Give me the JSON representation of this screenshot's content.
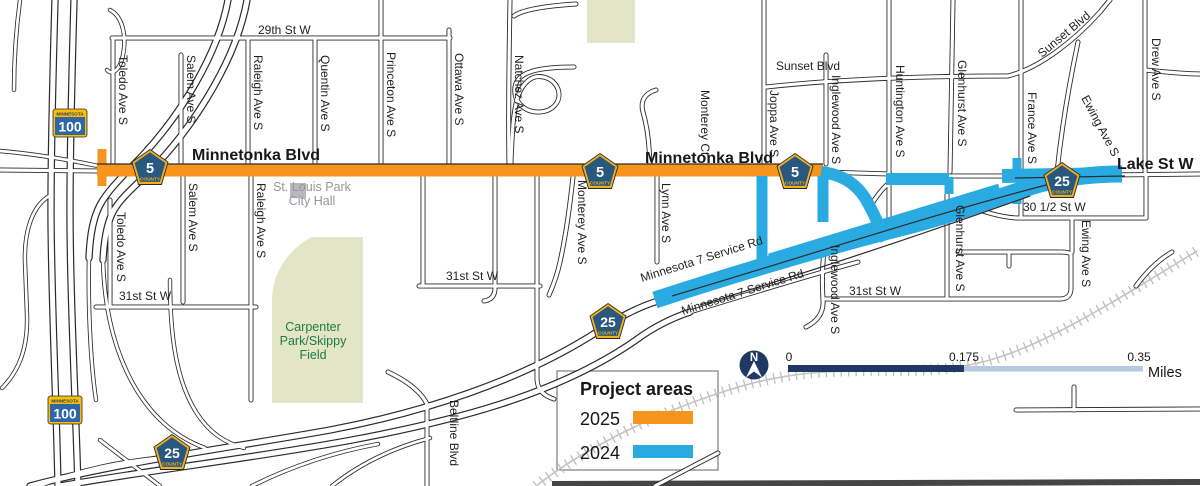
{
  "colors": {
    "orange_2025": "#F7941D",
    "blue_2024": "#29ABE2",
    "park_green": "#E3E5C7",
    "park_text_green": "#1E7A46",
    "gray_text": "#97969A",
    "navy": "#1F3864",
    "scale_light": "#B7C9E2",
    "shield_blue": "#29587E",
    "shield_gold": "#F2B01E",
    "state_blue": "#2E66A7",
    "state_gold": "#FABD08",
    "rail_gray": "#C4C4C4"
  },
  "legend": {
    "title": "Project areas",
    "items": [
      {
        "label": "2025",
        "color": "#F7941D"
      },
      {
        "label": "2024",
        "color": "#29ABE2"
      }
    ]
  },
  "scale_bar": {
    "zero": "0",
    "mid": "0.175",
    "max": "0.35",
    "unit": "Miles"
  },
  "north_arrow": {
    "letter": "N"
  },
  "shields": {
    "state": {
      "caption": "MINNESOTA",
      "number": "100"
    },
    "county_5": {
      "number": "5",
      "caption": "COUNTY"
    },
    "county_25": {
      "number": "25",
      "caption": "COUNTY"
    }
  },
  "major_roads": {
    "minnetonka_west": "Minnetonka Blvd",
    "minnetonka_east": "Minnetonka Blvd",
    "lake_st": "Lake St W"
  },
  "places": {
    "city_hall": {
      "line1": "St. Louis Park",
      "line2": "City Hall"
    },
    "carpenter_park": {
      "line1": "Carpenter",
      "line2": "Park/Skippy",
      "line3": "Field"
    }
  },
  "streets": {
    "s29th": "29th St W",
    "toledo": "Toledo Ave S",
    "salem": "Salem Ave S",
    "raleigh": "Raleigh Ave S",
    "quentin": "Quentin Ave S",
    "princeton": "Princeton Ave S",
    "ottawa": "Ottawa Ave S",
    "natchez": "Natchez Ave S",
    "monterey_ct": "Monterey Ct",
    "monterey_ave": "Monterey Ave S",
    "lynn": "Lynn Ave S",
    "joppa": "Joppa Ave S",
    "sunset": "Sunset Blvd",
    "inglewood": "Inglewood Ave S",
    "huntington": "Huntington Ave S",
    "glenhurst": "Glenhurst Ave S",
    "france": "France Ave S",
    "ewing": "Ewing Ave S",
    "drew": "Drew Ave S",
    "s31st": "31st St W",
    "s30half": "30 1/2 St W",
    "mn7service": "Minnesota 7 Service Rd",
    "beltline": "Beltline Blvd"
  }
}
